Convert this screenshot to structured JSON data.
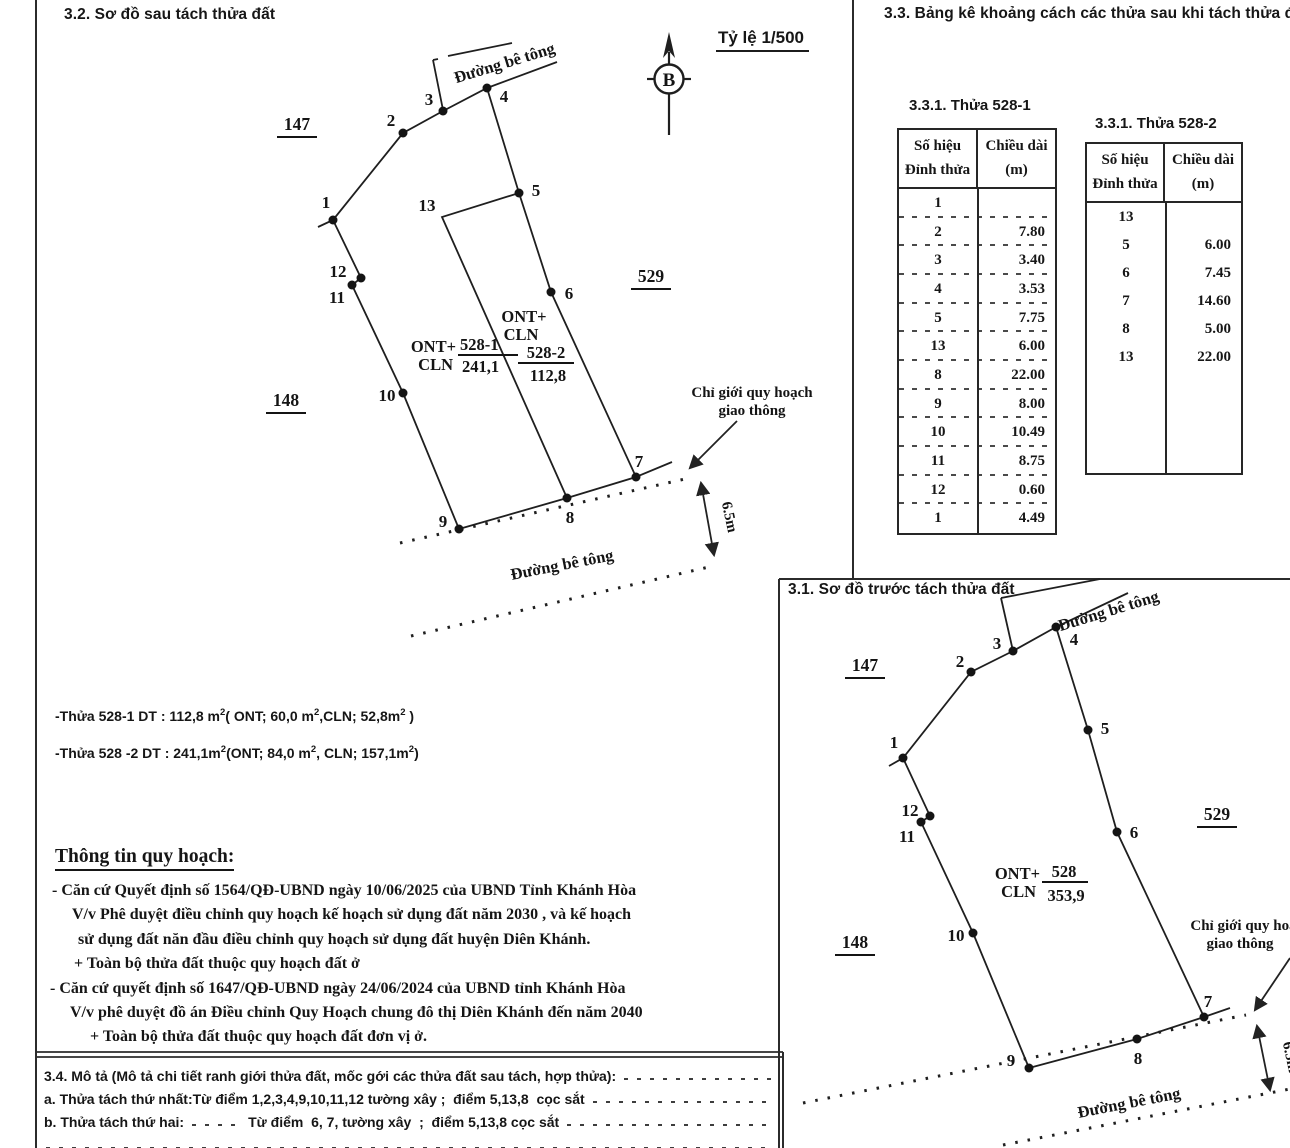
{
  "after": {
    "title": "3.2. Sơ đồ sau tách thửa đất",
    "scale": "Tỷ lệ 1/500",
    "north": "B",
    "road_top": "Đường bê tông",
    "road_bottom": "Đường bê tông",
    "boundary1": "Chỉ giới quy hoạch",
    "boundary2": "giao thông",
    "dim": "6.5m",
    "n147": "147",
    "n529": "529",
    "n148": "148",
    "plotA": {
      "u1": "ONT+",
      "u2": "CLN",
      "id": "528-1",
      "area": "241,1"
    },
    "plotB": {
      "u1": "ONT+",
      "u2": "CLN",
      "id": "528-2",
      "area": "112,8"
    },
    "pts": {
      "p1": "1",
      "p2": "2",
      "p3": "3",
      "p4": "4",
      "p5": "5",
      "p6": "6",
      "p7": "7",
      "p8": "8",
      "p9": "9",
      "p10": "10",
      "p11": "11",
      "p12": "12",
      "p13": "13"
    }
  },
  "before": {
    "title": "3.1. Sơ đồ trước tách thửa đất",
    "road_top": "Đường bê tông",
    "road_bottom": "Đường bê tông",
    "boundary1": "Chỉ giới quy hoạch",
    "boundary2": "giao thông",
    "dim": "6.5m",
    "n147": "147",
    "n529": "529",
    "n148": "148",
    "plot": {
      "u1": "ONT+",
      "u2": "CLN",
      "id": "528",
      "area": "353,9"
    },
    "pts": {
      "p1": "1",
      "p2": "2",
      "p3": "3",
      "p4": "4",
      "p5": "5",
      "p6": "6",
      "p7": "7",
      "p8": "8",
      "p9": "9",
      "p10": "10",
      "p11": "11",
      "p12": "12"
    }
  },
  "tables": {
    "heading": "3.3. Bảng kê khoảng cách các thửa sau khi tách thửa đất",
    "t1": {
      "title": "3.3.1. Thửa 528-1",
      "h1a": "Số hiệu",
      "h1b": "Đỉnh thửa",
      "h2a": "Chiều dài",
      "h2b": "(m)",
      "rows": [
        [
          "1",
          ""
        ],
        [
          "2",
          "7.80"
        ],
        [
          "3",
          "3.40"
        ],
        [
          "4",
          "3.53"
        ],
        [
          "5",
          "7.75"
        ],
        [
          "13",
          "6.00"
        ],
        [
          "8",
          "22.00"
        ],
        [
          "9",
          "8.00"
        ],
        [
          "10",
          "10.49"
        ],
        [
          "11",
          "8.75"
        ],
        [
          "12",
          "0.60"
        ],
        [
          "1",
          "4.49"
        ]
      ]
    },
    "t2": {
      "title": "3.3.1. Thửa 528-2",
      "h1a": "Số hiệu",
      "h1b": "Đỉnh thửa",
      "h2a": "Chiều dài",
      "h2b": "(m)",
      "rows": [
        [
          "13",
          ""
        ],
        [
          "5",
          "6.00"
        ],
        [
          "6",
          "7.45"
        ],
        [
          "7",
          "14.60"
        ],
        [
          "8",
          "5.00"
        ],
        [
          "13",
          "22.00"
        ]
      ]
    }
  },
  "notes": {
    "l1": [
      "-Thửa 528-1 DT : 112,8 m",
      "2",
      "( ONT; 60,0 m",
      "2",
      ",CLN; 52,8m",
      "2",
      " )"
    ],
    "l2": [
      "-Thửa 528 -2 DT : 241,1m",
      "2",
      "(ONT; 84,0 m",
      "2",
      ", CLN; 157,1m",
      "2",
      ")"
    ]
  },
  "planning": {
    "heading": "Thông tin quy hoạch:",
    "l1": "- Căn cứ Quyết định số 1564/QĐ-UBND ngày 10/06/2025 của UBND Tỉnh Khánh Hòa",
    "l2": "V/v Phê duyệt điều chỉnh quy hoạch kế hoạch sử dụng đất năm 2030 , và kế hoạch",
    "l3": "sử dụng đất năn đầu điều chỉnh quy hoạch  sử dụng đất huyện Diên Khánh.",
    "l4": "+ Toàn bộ thửa đất thuộc quy hoạch đất ở",
    "l5": "- Căn cứ quyết định số 1647/QĐ-UBND ngày 24/06/2024 của UBND tỉnh Khánh Hòa",
    "l6": "V/v phê duyệt đồ án Điều chỉnh Quy Hoạch chung đô thị Diên Khánh đến năm 2040",
    "l7": "+ Toàn bộ thửa đất thuộc quy hoạch đất đơn vị ở."
  },
  "desc": {
    "l1": "3.4. Mô tả (Mô tả chi tiết ranh giới thửa đất, mốc gới các thửa đất sau tách, hợp thửa):",
    "l2": "a. Thửa tách thứ nhất:Từ điểm 1,2,3,4,9,10,11,12 tường xây ;  điểm 5,13,8  cọc sắt",
    "l3a": "b. Thửa tách thứ hai:",
    "l3b": "Từ điểm  6, 7, tường xây  ;  điểm 5,13,8 cọc sắt"
  }
}
